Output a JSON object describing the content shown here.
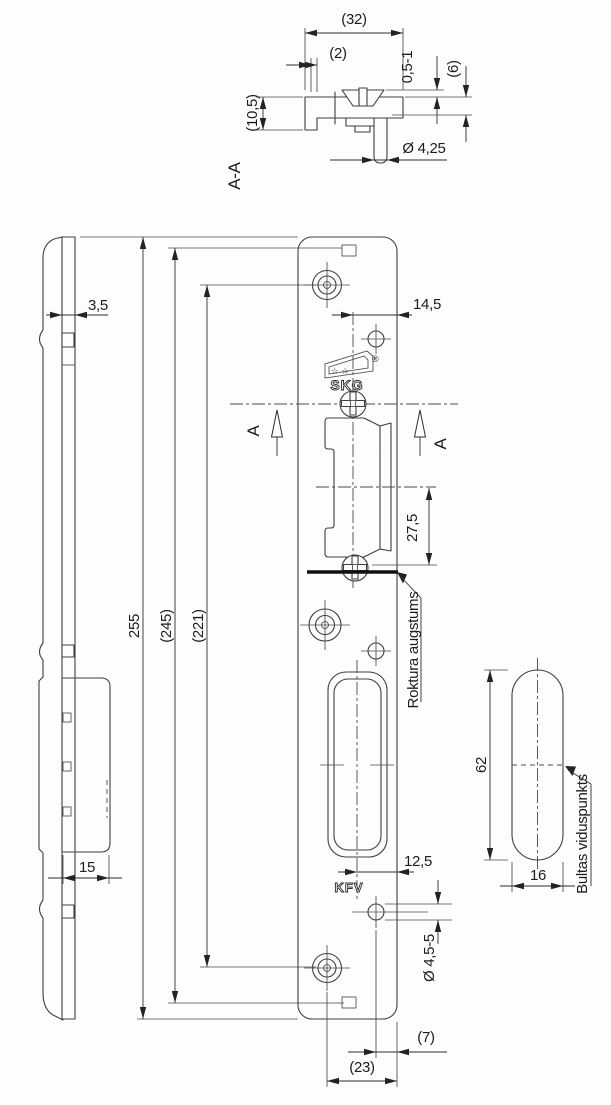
{
  "views": {
    "section": {
      "label": "A-A",
      "dim_width": "(32)",
      "dim_lip": "(2)",
      "dim_protrusion": "0,5-1",
      "dim_depth": "(6)",
      "dim_flange": "(10,5)",
      "dim_pin_diameter": "Ø 4,25"
    },
    "front": {
      "dim_center_to_edge": "14,5",
      "skg_stars": "☆ ☆",
      "skg_text": "SKG",
      "skg_registered": "®",
      "section_marker_left": "A",
      "section_marker_right": "A",
      "dim_handle_offset": "27,5",
      "note_handle_height": "Roktura augstums",
      "kfv_text": "KFV",
      "dim_slot_to_edge": "12,5",
      "dim_hole_diameter": "Ø 4,5-5",
      "dim_hole_to_edge": "(7)",
      "dim_hole_to_hole": "(23)"
    },
    "side": {
      "dim_thickness": "3,5",
      "dim_housing_depth": "15"
    },
    "heights": {
      "dim_total": "255",
      "dim_notches": "(245)",
      "dim_screws": "(221)"
    },
    "detail": {
      "dim_height": "62",
      "dim_width": "16",
      "note_bolt_center": "Bultas viduspunkts"
    }
  },
  "colors": {
    "line": "#3f3f3f",
    "text": "#1c1c1c",
    "background": "#fdfdfd"
  }
}
